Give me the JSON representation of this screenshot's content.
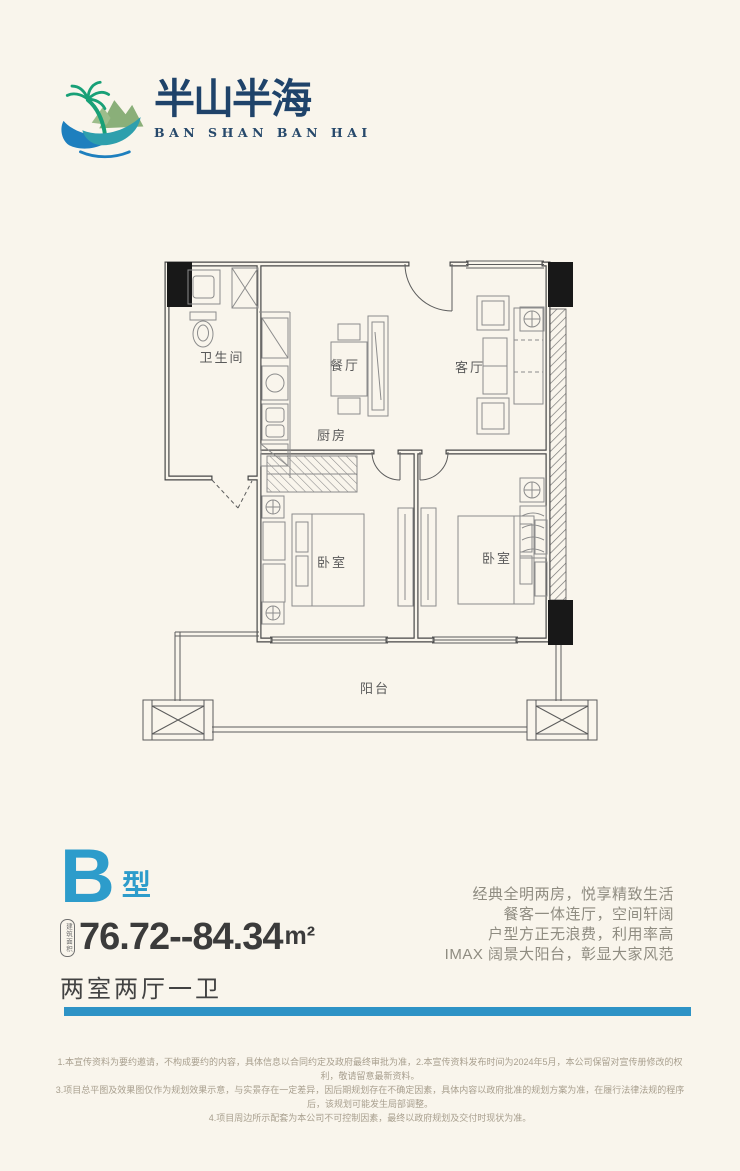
{
  "logo": {
    "name_cn": "半山半海",
    "name_en": "BAN SHAN BAN HAI"
  },
  "plan": {
    "rooms": [
      "卫生间",
      "餐厅",
      "客厅",
      "厨房",
      "卧室",
      "卧室",
      "阳台"
    ]
  },
  "unit": {
    "type_letter": "B",
    "type_suffix": "型",
    "area_label": "建筑面积",
    "area_value": "76.72--84.34",
    "area_unit": "m²",
    "layout_text": "两室两厅一卫"
  },
  "selling_points": [
    "经典全明两房，悦享精致生活",
    "餐客一体连厅，空间轩阔",
    "户型方正无浪费，利用率高",
    "IMAX 阔景大阳台，彰显大家风范"
  ],
  "disclaimer": [
    "1.本宣传资料为要约邀请，不构成要约的内容，具体信息以合同约定及政府最终审批为准，2.本宣传资料发布时间为2024年5月，本公司保留对宣传册修改的权利，敬请留意最新资料。",
    "3.项目总平图及效果图仅作为规划效果示意，与实景存在一定差异，因后期规划存在不确定因素，具体内容以政府批准的规划方案为准，在履行法律法规的程序后，该规划可能发生局部调整。",
    "4.项目周边所示配套为本公司不可控制因素，最终以政府规划及交付时现状为准。"
  ],
  "colors": {
    "accent_blue": "#2D9CCB",
    "rule_blue": "#2E93C6",
    "brand_navy": "#1F436A",
    "wave_blue": "#1E7FBE",
    "wave_teal": "#2E9FAD",
    "mountain_green": "#8AAF79",
    "palm_green": "#18A077",
    "background": "#F9F5EC"
  }
}
